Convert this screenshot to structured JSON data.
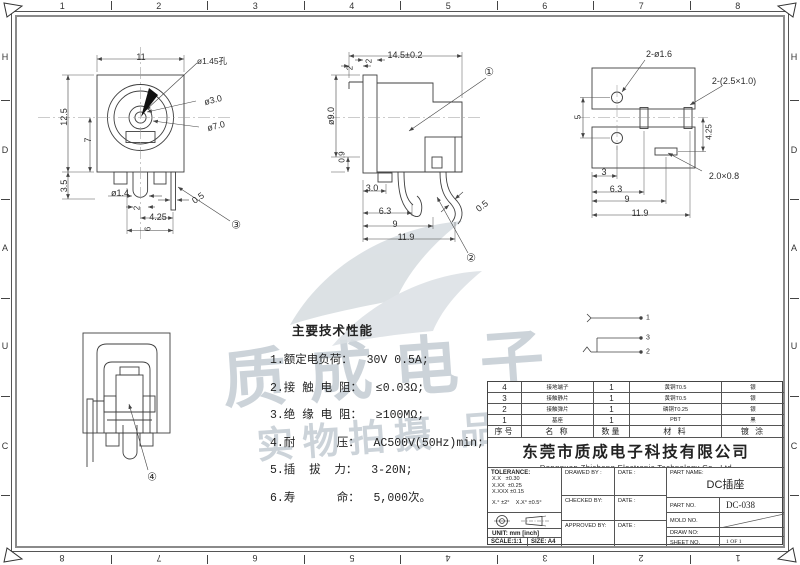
{
  "drawing": {
    "border": {
      "top_numbers": [
        "1",
        "2",
        "3",
        "4",
        "5",
        "6",
        "7",
        "8"
      ],
      "bottom_numbers": [
        "8",
        "7",
        "6",
        "5",
        "4",
        "3",
        "2",
        "1"
      ],
      "left_letters": [
        "H",
        "D",
        "A",
        "U",
        "C"
      ],
      "right_letters": [
        "H",
        "D",
        "A",
        "U",
        "C"
      ]
    },
    "watermark": {
      "line1": "质成电子",
      "line2": "实物拍摄 品质保证",
      "color": "#ccd3d9"
    },
    "dim_labels": [
      {
        "t": "11",
        "x": 141,
        "y": 57
      },
      {
        "t": "ø1.45孔",
        "x": 212,
        "y": 61,
        "s": 8.5
      },
      {
        "t": "ø3.0",
        "x": 213,
        "y": 100,
        "r": -14
      },
      {
        "t": "ø7.0",
        "x": 216,
        "y": 126,
        "r": -14
      },
      {
        "t": "12.5",
        "x": 64,
        "y": 117,
        "r": -90
      },
      {
        "t": "7",
        "x": 88,
        "y": 140,
        "r": -90
      },
      {
        "t": "3.5",
        "x": 64,
        "y": 186,
        "r": -90
      },
      {
        "t": "ø1.4",
        "x": 120,
        "y": 193,
        "s": 9
      },
      {
        "t": "2",
        "x": 137,
        "y": 208,
        "r": -90,
        "s": 8
      },
      {
        "t": "4.25",
        "x": 158,
        "y": 217,
        "s": 9
      },
      {
        "t": "6",
        "x": 148,
        "y": 229,
        "r": -90,
        "s": 8
      },
      {
        "t": "0.5",
        "x": 198,
        "y": 198,
        "r": -35,
        "s": 9
      },
      {
        "t": "③",
        "x": 236,
        "y": 225,
        "s": 11
      },
      {
        "t": "14.5±0.2",
        "x": 405,
        "y": 55
      },
      {
        "t": "2",
        "x": 350,
        "y": 68,
        "r": -90,
        "s": 8
      },
      {
        "t": "2",
        "x": 369,
        "y": 61,
        "r": -90,
        "s": 8
      },
      {
        "t": "ø9.0",
        "x": 331,
        "y": 116,
        "r": -90
      },
      {
        "t": "0.9",
        "x": 342,
        "y": 157,
        "r": -90,
        "s": 8
      },
      {
        "t": "3.0",
        "x": 372,
        "y": 188,
        "s": 9
      },
      {
        "t": "6.3",
        "x": 385,
        "y": 211,
        "s": 9
      },
      {
        "t": "9",
        "x": 395,
        "y": 224,
        "s": 9
      },
      {
        "t": "11.9",
        "x": 406,
        "y": 237,
        "s": 9
      },
      {
        "t": "0.5",
        "x": 482,
        "y": 206,
        "r": -38,
        "s": 9
      },
      {
        "t": "①",
        "x": 489,
        "y": 72,
        "s": 11
      },
      {
        "t": "②",
        "x": 471,
        "y": 258,
        "s": 11
      },
      {
        "t": "2-ø1.6",
        "x": 659,
        "y": 54,
        "s": 9
      },
      {
        "t": "2-(2.5×1.0)",
        "x": 734,
        "y": 81,
        "s": 9
      },
      {
        "t": "5",
        "x": 578,
        "y": 117,
        "r": -90,
        "s": 8
      },
      {
        "t": "4.25",
        "x": 709,
        "y": 132,
        "r": -90,
        "s": 8
      },
      {
        "t": "3",
        "x": 604,
        "y": 172,
        "s": 9
      },
      {
        "t": "6.3",
        "x": 616,
        "y": 189,
        "s": 9
      },
      {
        "t": "9",
        "x": 627,
        "y": 199,
        "s": 9
      },
      {
        "t": "11.9",
        "x": 640,
        "y": 213,
        "s": 9
      },
      {
        "t": "2.0×0.8",
        "x": 724,
        "y": 176,
        "s": 9
      },
      {
        "t": "④",
        "x": 152,
        "y": 477,
        "s": 11
      },
      {
        "t": "1",
        "x": 648,
        "y": 318,
        "s": 7
      },
      {
        "t": "3",
        "x": 648,
        "y": 338,
        "s": 7
      },
      {
        "t": "2",
        "x": 648,
        "y": 352,
        "s": 7
      }
    ],
    "specs": {
      "title": "主要技术性能",
      "items": [
        "1.额定电负荷：  30V 0.5A;",
        "2.接 触 电 阻：  ≤0.03Ω;",
        "3.绝 缘 电 阻：  ≥100MΩ;",
        "4.耐      压：  AC500V(50Hz)min;",
        "5.插  拔  力：  3-20N;",
        "6.寿      命：  5,000次。"
      ]
    },
    "bom": {
      "headers": [
        "序号",
        "名  称",
        "数量",
        "材  料",
        "镀  涂"
      ],
      "rows": [
        [
          "4",
          "接地端子",
          "1",
          "黄铜T0.5",
          "银"
        ],
        [
          "3",
          "接触静片",
          "1",
          "黄铜T0.5",
          "银"
        ],
        [
          "2",
          "接触弹片",
          "1",
          "磷铜T0.25",
          "银"
        ],
        [
          "1",
          "基座",
          "1",
          "PBT",
          "黑"
        ]
      ]
    },
    "company": {
      "cn": "东莞市质成电子科技有限公司",
      "en": "Dongguan Zhicheng Electronic Technology Co., Ltd"
    },
    "titleblock": {
      "tolerance_label": "TOLERANCE:",
      "tolerance_lines": [
        "X.X   ±0.30",
        "X.XX  ±0.25",
        "X.XXX ±0.15",
        "X.° ±2°    X.X° ±0.5°"
      ],
      "unit": "UNIT: mm [inch]",
      "scale": "SCALE:1:1",
      "size": "SIZE: A4",
      "drawed_label": "DRAWED BY :",
      "checked_label": "CHECKED BY:",
      "approved_label": "APPROVED BY:",
      "date_label": "DATE :",
      "part_name_label": "PART NAME:",
      "part_name_value": "DC插座",
      "part_no_label": "PART NO.",
      "part_no_value": "DC-038",
      "mold_no_label": "MOLD NO.",
      "draw_no_label": "DRAW NO:",
      "sheet_no_label": "SHEET NO.",
      "sheet_no_value": "1 OF 1"
    }
  }
}
